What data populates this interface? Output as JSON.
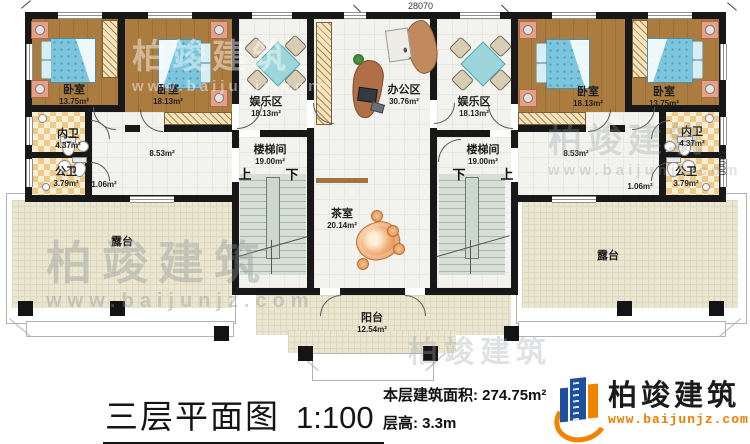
{
  "title_block": {
    "title": "三层平面图",
    "scale": "1:100",
    "area_label": "本层建筑面积:",
    "area_value": "274.75m²",
    "floor_height_label": "层高:",
    "floor_height_value": "3.3m"
  },
  "logo": {
    "name": "柏竣建筑",
    "url": "www.baijunjz.com"
  },
  "watermark": {
    "name": "柏竣建筑",
    "url": "www.baijunjz.com"
  },
  "dimensions": {
    "top": "28070",
    "right": "14000"
  },
  "stair_labels": {
    "up": "上",
    "down": "下"
  },
  "rooms": {
    "bedroom_far_left": {
      "name": "卧室",
      "area": "13.75m²"
    },
    "bedroom_left": {
      "name": "卧室",
      "area": "18.13m²"
    },
    "bath_private_left": {
      "name": "内卫",
      "area": "4.37m²"
    },
    "bath_public_left": {
      "name": "公卫",
      "area": "3.79m²"
    },
    "hall_left_area": "8.53m²",
    "nook_left_area": "1.06m²",
    "entertainment_left": {
      "name": "娱乐区",
      "area": "18.13m²"
    },
    "office": {
      "name": "办公区",
      "area": "30.76m²"
    },
    "entertainment_right": {
      "name": "娱乐区",
      "area": "18.13m²"
    },
    "stair_left": {
      "name": "楼梯间",
      "area": "19.00m²"
    },
    "stair_right": {
      "name": "楼梯间",
      "area": "19.00m²"
    },
    "tea_room": {
      "name": "茶室",
      "area": "20.14m²"
    },
    "balcony": {
      "name": "阳台",
      "area": "12.54m²"
    },
    "terrace_left": {
      "name": "露台"
    },
    "terrace_right": {
      "name": "露台"
    },
    "bedroom_right": {
      "name": "卧室",
      "area": "18.13m²"
    },
    "bedroom_far_right": {
      "name": "卧室",
      "area": "13.75m²"
    },
    "bath_private_right": {
      "name": "内卫",
      "area": "4.37m²"
    },
    "bath_public_right": {
      "name": "公卫",
      "area": "3.79m²"
    },
    "hall_right_area": "8.53m²",
    "nook_right_area": "1.06m²"
  }
}
